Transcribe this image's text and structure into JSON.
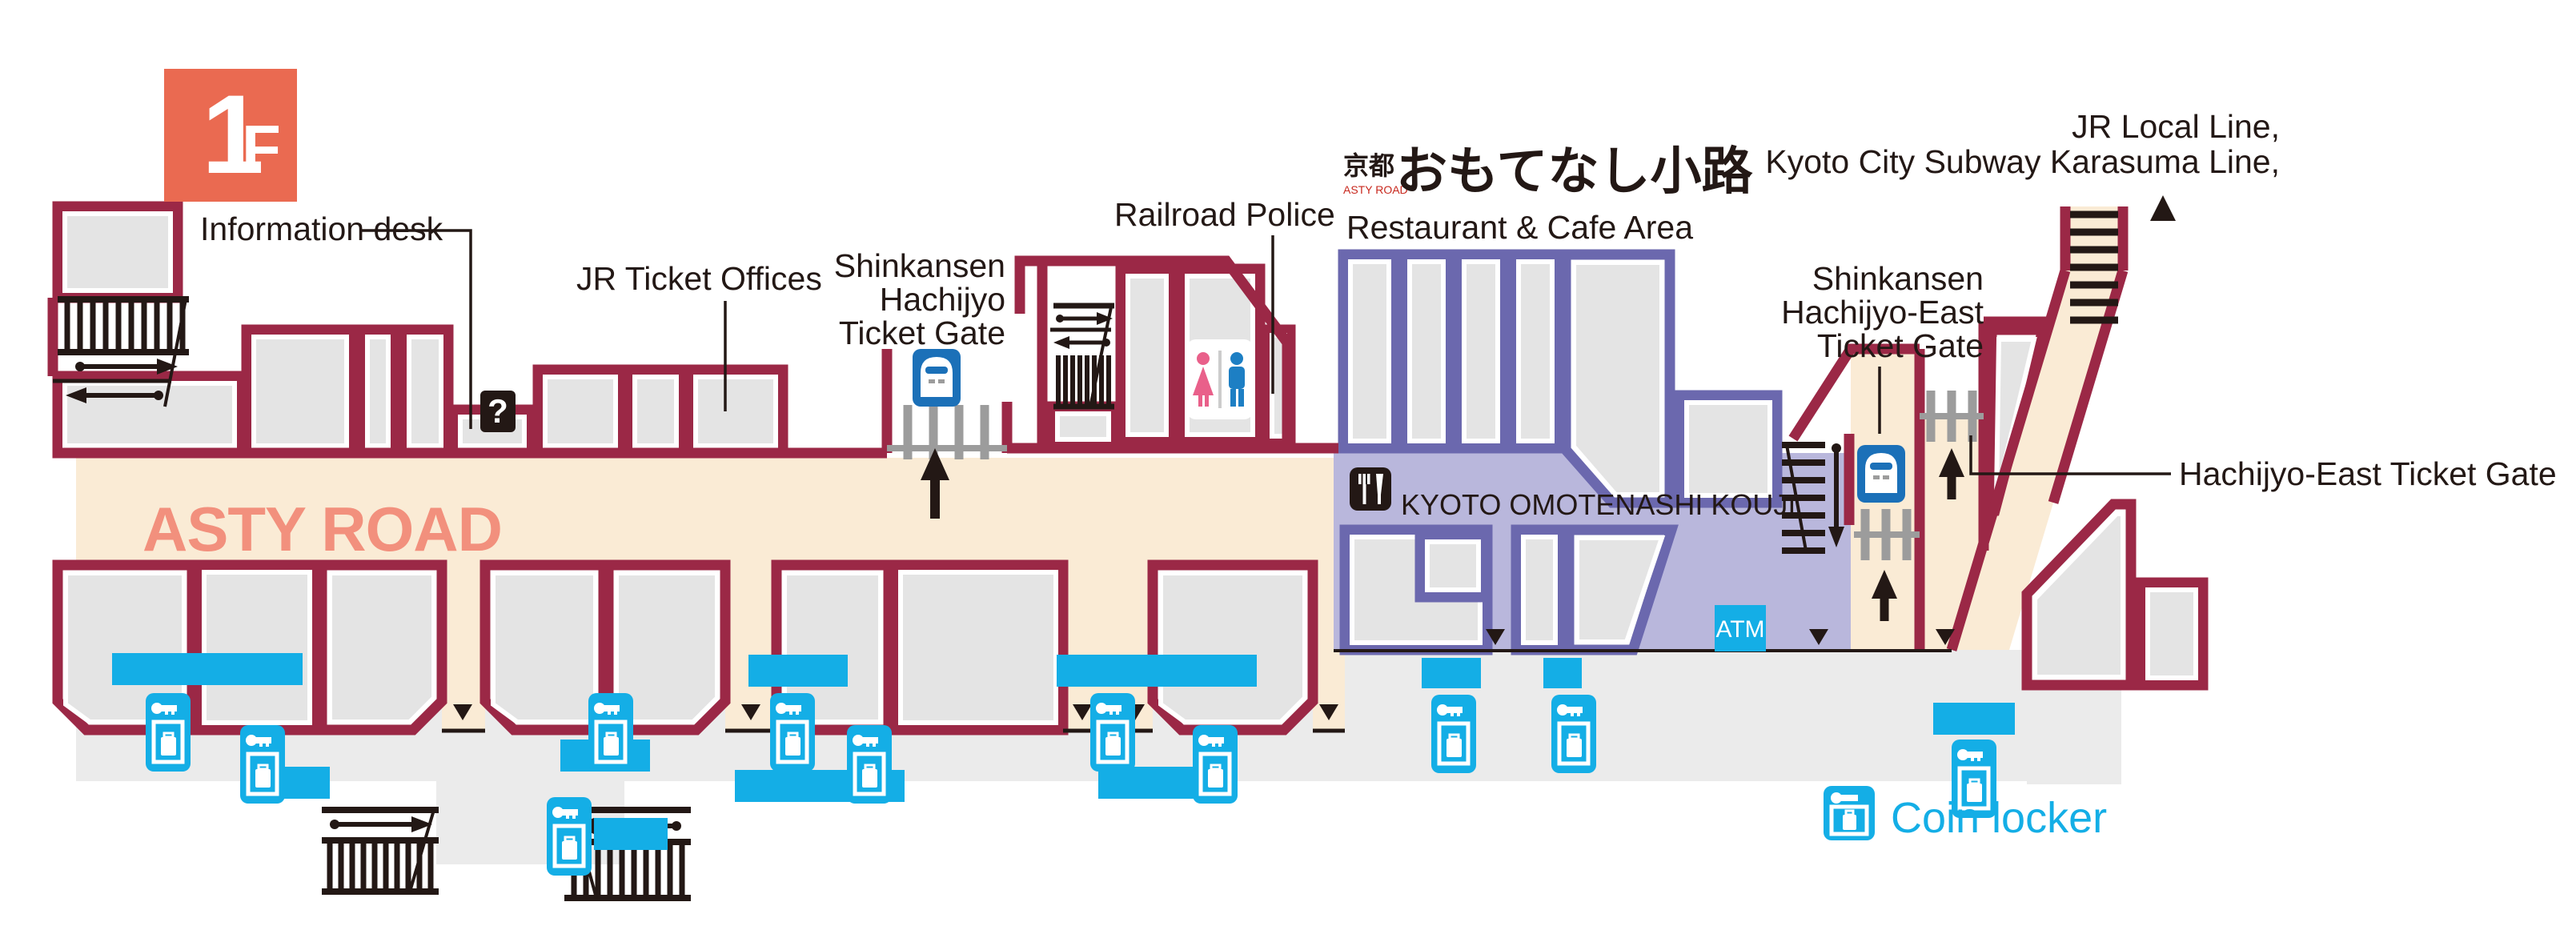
{
  "page": {
    "title": "Kyoto Station ASTY ROAD 1F Floor Map"
  },
  "floor_badge": {
    "number": "1",
    "suffix": "F"
  },
  "road": {
    "name": "ASTY ROAD"
  },
  "labels": {
    "information_desk": "Information desk",
    "jr_ticket_offices": "JR Ticket Offices",
    "shinkansen_hachijyo_l1": "Shinkansen",
    "shinkansen_hachijyo_l2": "Hachijyo",
    "shinkansen_hachijyo_l3": "Ticket Gate",
    "railroad_police": "Railroad Police",
    "restaurant_cafe_area": "Restaurant & Cafe Area",
    "jr_local_l1": "JR Local Line,",
    "jr_local_l2": "Kyoto City Subway Karasuma Line,",
    "shinkansen_hachijyo_east_l1": "Shinkansen",
    "shinkansen_hachijyo_east_l2": "Hachijyo-East",
    "shinkansen_hachijyo_east_l3": "Ticket Gate",
    "hachijyo_east_gate": "Hachijyo-East Ticket Gate",
    "kyoto_omotenashi_kouji": "KYOTO OMOTENASHI KOUJI",
    "atm": "ATM",
    "info_mark": "?"
  },
  "restaurant_logo": {
    "prefix": "京都",
    "sub": "ASTY ROAD",
    "main": "おもてなし小路"
  },
  "legend": {
    "coin_locker": "Coin locker"
  },
  "colors": {
    "wall": "#9B2846",
    "room_fill": "#E4E4E4",
    "floor": "#EBEBEB",
    "road": "#FAEBD5",
    "road_text": "#F2907D",
    "restaurant_wall": "#6B68AE",
    "restaurant_floor": "#B9B7DC",
    "accent_cyan": "#14AEE6",
    "badge": "#EA6A51",
    "shinkansen_blue": "#1B70B8",
    "text": "#231815"
  }
}
